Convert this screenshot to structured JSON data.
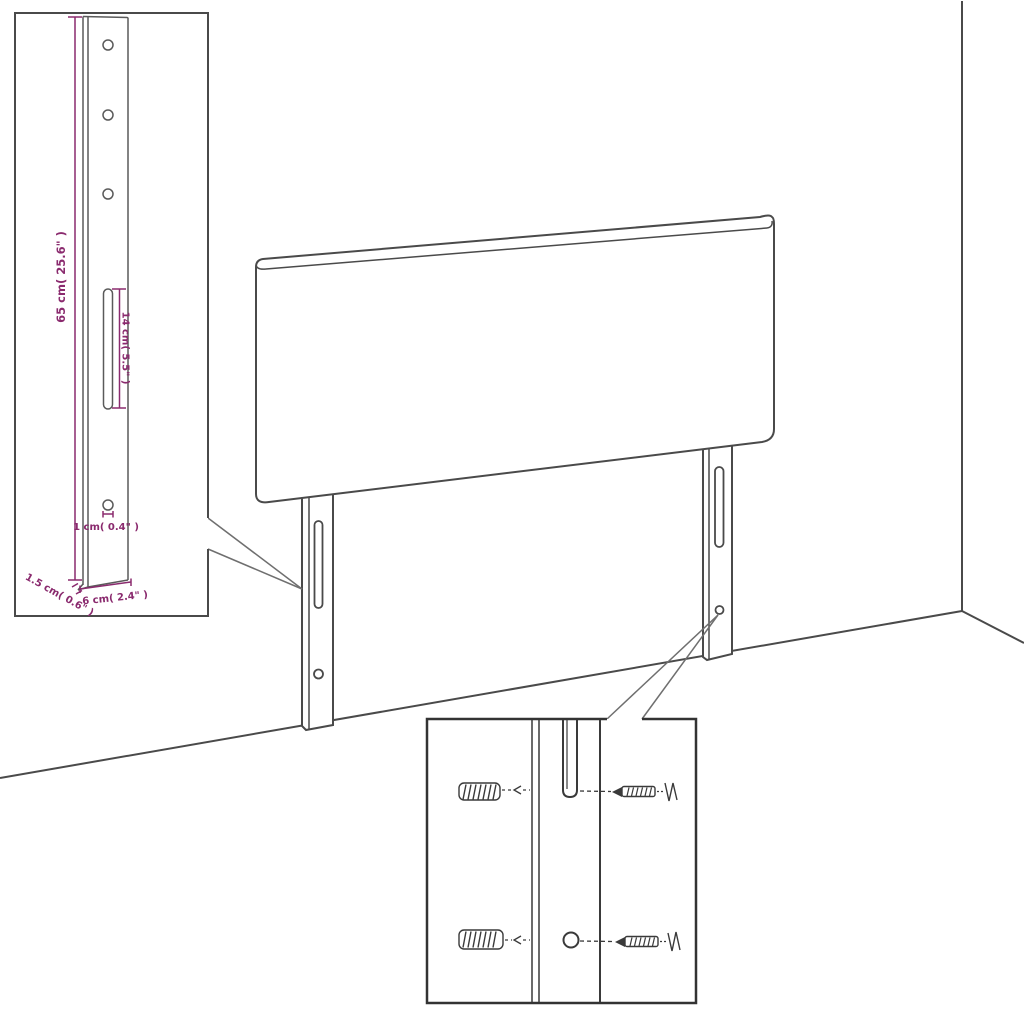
{
  "diagram": {
    "kind": "furniture-dimension-line-drawing",
    "colors": {
      "line": "#4a4a4a",
      "inset_border": "#333333",
      "dimension_accent": "#8a2a6e",
      "background": "#ffffff"
    },
    "dimensions": {
      "leg_height": "65 cm( 25.6\" )",
      "slot_length": "14 cm( 5.5\" )",
      "hole_diameter": "1 cm( 0.4\" )",
      "leg_thickness": "1.5 cm( 0.6\" )",
      "leg_width": "6 cm( 2.4\" )"
    }
  }
}
